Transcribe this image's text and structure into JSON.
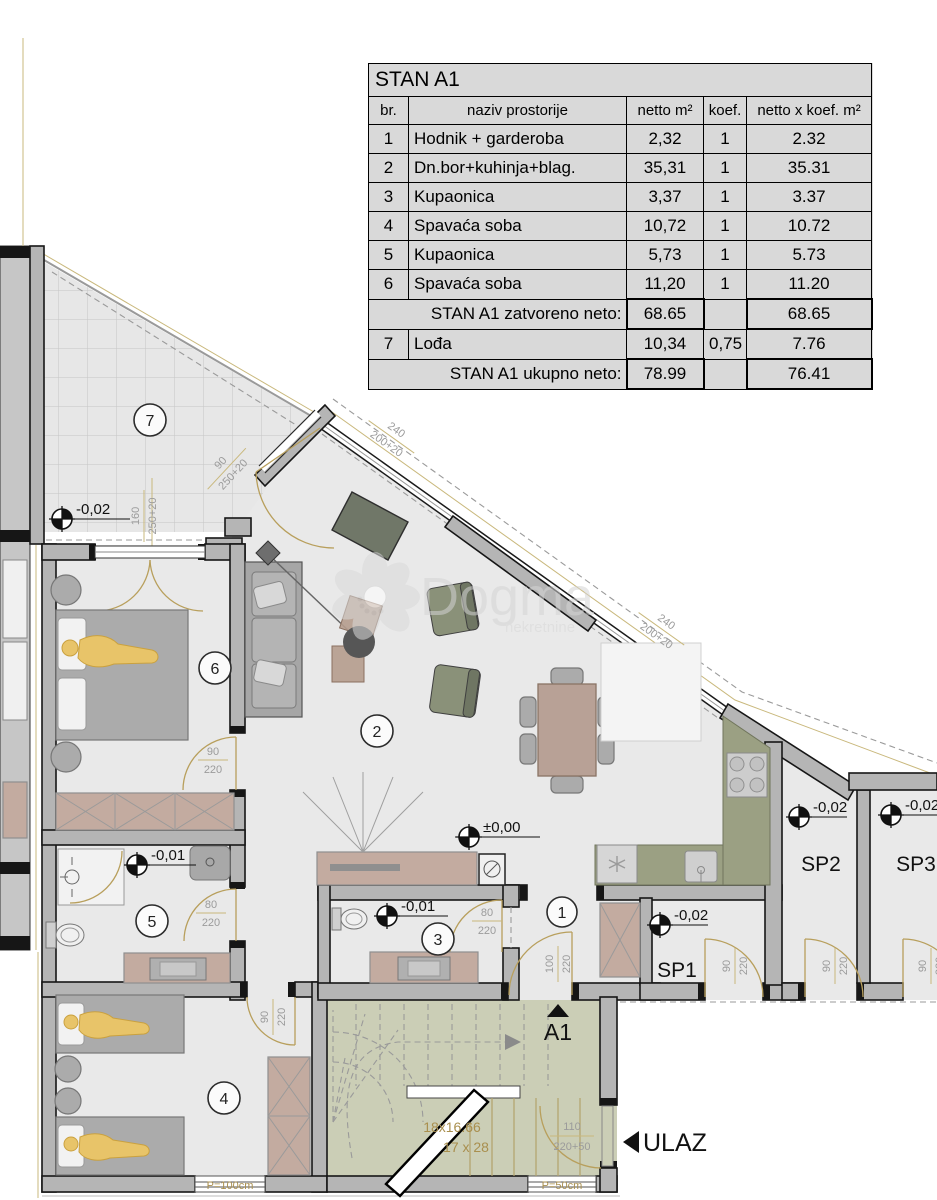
{
  "table": {
    "title": "STAN A1",
    "headers": [
      "br.",
      "naziv prostorije",
      "netto m²",
      "koef.",
      "netto x koef. m²"
    ],
    "rows": [
      {
        "br": "1",
        "name": "Hodnik + garderoba",
        "netto": "2,32",
        "koef": "1",
        "total": "2.32"
      },
      {
        "br": "2",
        "name": "Dn.bor+kuhinja+blag.",
        "netto": "35,31",
        "koef": "1",
        "total": "35.31"
      },
      {
        "br": "3",
        "name": "Kupaonica",
        "netto": "3,37",
        "koef": "1",
        "total": "3.37"
      },
      {
        "br": "4",
        "name": "Spavaća soba",
        "netto": "10,72",
        "koef": "1",
        "total": "10.72"
      },
      {
        "br": "5",
        "name": "Kupaonica",
        "netto": "5,73",
        "koef": "1",
        "total": "5.73"
      },
      {
        "br": "6",
        "name": "Spavaća soba",
        "netto": "11,20",
        "koef": "1",
        "total": "11.20"
      }
    ],
    "subtotal": {
      "label": "STAN A1 zatvoreno neto:",
      "netto": "68.65",
      "koef": "",
      "total": "68.65"
    },
    "row7": {
      "br": "7",
      "name": "Lođa",
      "netto": "10,34",
      "koef": "0,75",
      "total": "7.76"
    },
    "total": {
      "label": "STAN A1 ukupno neto:",
      "netto": "78.99",
      "koef": "",
      "total": "76.41"
    }
  },
  "plan": {
    "rooms": {
      "r1": "1",
      "r2": "2",
      "r3": "3",
      "r4": "4",
      "r5": "5",
      "r6": "6",
      "r7": "7"
    },
    "storage": {
      "sp1": "SP1",
      "sp2": "SP2",
      "sp3": "SP3"
    },
    "elevations": {
      "loggia": "-0,02",
      "living": "±0,00",
      "bath5": "-0,01",
      "bath3": "-0,01",
      "sp1": "-0,02",
      "sp2": "-0,02",
      "sp3": "-0,02"
    },
    "dims": {
      "loggia_w": {
        "a": "160",
        "b": "250+20"
      },
      "loggia_door": {
        "a": "90",
        "b": "250+20"
      },
      "win1": {
        "a": "240",
        "b": "200+20"
      },
      "win2": {
        "a": "240",
        "b": "200+20"
      },
      "door6": {
        "a": "90",
        "b": "220"
      },
      "door5": {
        "a": "80",
        "b": "220"
      },
      "door4": {
        "a": "90",
        "b": "220"
      },
      "door3": {
        "a": "80",
        "b": "220"
      },
      "door1": {
        "a": "100",
        "b": "220"
      },
      "sp1_door": {
        "a": "90",
        "b": "220"
      },
      "sp2_door": {
        "a": "90",
        "b": "220"
      },
      "sp3_door": {
        "a": "90",
        "b": "220"
      },
      "entry_door": {
        "a": "110",
        "b": "220+50"
      }
    },
    "stairs": {
      "steps": "18x16.66",
      "tread": "17 x 28"
    },
    "entry": {
      "unit": "A1",
      "label": "ULAZ"
    },
    "parapets": {
      "p100": "P=100cm",
      "p50": "P=50cm"
    },
    "watermark": {
      "name": "Dogma",
      "sub": "nekretnine"
    }
  }
}
